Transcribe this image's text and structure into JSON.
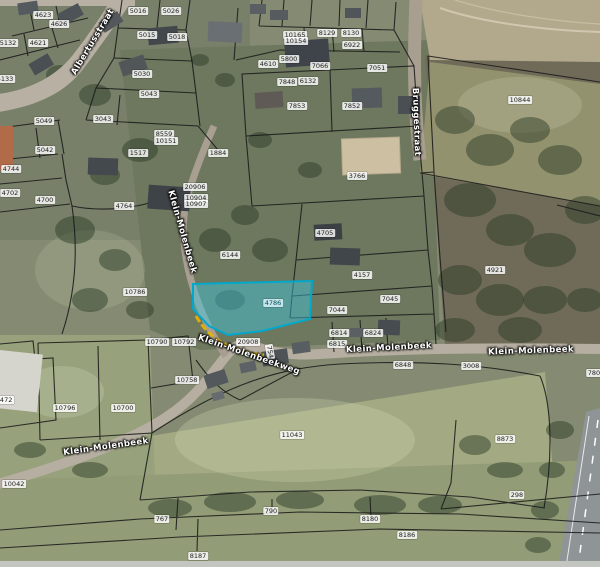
{
  "map": {
    "type": "cadastral-parcels-over-aerial-photo",
    "colors": {
      "highlight_fill": "#3fc8e2",
      "highlight_stroke": "#00a8cc",
      "selection_outline": "#e9b400",
      "parcel_boundary": "#1a1a1a",
      "label_background": "#ffffff",
      "label_text": "#1c1c1c"
    },
    "highlighted_parcel": {
      "id": "4786",
      "x": 273,
      "y": 303
    },
    "parcel_labels": [
      {
        "id": "4623",
        "x": 43,
        "y": 15
      },
      {
        "id": "4626",
        "x": 59,
        "y": 24
      },
      {
        "id": "4621",
        "x": 38,
        "y": 43
      },
      {
        "id": "5132",
        "x": 8,
        "y": 43
      },
      {
        "id": "5133",
        "x": 5,
        "y": 79
      },
      {
        "id": "5016",
        "x": 138,
        "y": 11
      },
      {
        "id": "5026",
        "x": 171,
        "y": 11
      },
      {
        "id": "5015",
        "x": 147,
        "y": 35
      },
      {
        "id": "5018",
        "x": 177,
        "y": 37
      },
      {
        "id": "5030",
        "x": 142,
        "y": 74
      },
      {
        "id": "5043",
        "x": 149,
        "y": 94
      },
      {
        "id": "3043",
        "x": 103,
        "y": 119
      },
      {
        "id": "5049",
        "x": 44,
        "y": 121
      },
      {
        "id": "8559",
        "x": 164,
        "y": 134
      },
      {
        "id": "10151",
        "x": 166,
        "y": 141
      },
      {
        "id": "1517",
        "x": 138,
        "y": 153
      },
      {
        "id": "5042",
        "x": 45,
        "y": 150
      },
      {
        "id": "4744",
        "x": 11,
        "y": 169
      },
      {
        "id": "4702",
        "x": 10,
        "y": 193
      },
      {
        "id": "4700",
        "x": 45,
        "y": 200
      },
      {
        "id": "10165",
        "x": 295,
        "y": 35
      },
      {
        "id": "10154",
        "x": 296,
        "y": 41
      },
      {
        "id": "8129",
        "x": 327,
        "y": 33
      },
      {
        "id": "8130",
        "x": 351,
        "y": 33
      },
      {
        "id": "6922",
        "x": 352,
        "y": 45
      },
      {
        "id": "5800",
        "x": 289,
        "y": 59
      },
      {
        "id": "4610",
        "x": 268,
        "y": 64
      },
      {
        "id": "7066",
        "x": 320,
        "y": 66
      },
      {
        "id": "7051",
        "x": 377,
        "y": 68
      },
      {
        "id": "7848",
        "x": 287,
        "y": 82
      },
      {
        "id": "6132",
        "x": 308,
        "y": 81
      },
      {
        "id": "7853",
        "x": 297,
        "y": 106
      },
      {
        "id": "7852",
        "x": 352,
        "y": 106
      },
      {
        "id": "1884",
        "x": 218,
        "y": 153
      },
      {
        "id": "20906",
        "x": 195,
        "y": 187
      },
      {
        "id": "10904",
        "x": 196,
        "y": 198
      },
      {
        "id": "10907",
        "x": 196,
        "y": 204
      },
      {
        "id": "4764",
        "x": 124,
        "y": 206
      },
      {
        "id": "3766",
        "x": 357,
        "y": 176
      },
      {
        "id": "4705",
        "x": 325,
        "y": 233
      },
      {
        "id": "6144",
        "x": 230,
        "y": 255
      },
      {
        "id": "4157",
        "x": 362,
        "y": 275
      },
      {
        "id": "10786",
        "x": 135,
        "y": 292
      },
      {
        "id": "7045",
        "x": 390,
        "y": 299
      },
      {
        "id": "7044",
        "x": 337,
        "y": 310
      },
      {
        "id": "6814",
        "x": 339,
        "y": 333
      },
      {
        "id": "6824",
        "x": 373,
        "y": 333
      },
      {
        "id": "6815",
        "x": 337,
        "y": 344
      },
      {
        "id": "6848",
        "x": 403,
        "y": 365
      },
      {
        "id": "3008",
        "x": 471,
        "y": 366
      },
      {
        "id": "10844",
        "x": 520,
        "y": 100
      },
      {
        "id": "4921",
        "x": 495,
        "y": 270
      },
      {
        "id": "20908",
        "x": 248,
        "y": 342
      },
      {
        "id": "754",
        "x": 270,
        "y": 352,
        "rotation": 80
      },
      {
        "id": "10790",
        "x": 157,
        "y": 342
      },
      {
        "id": "10792",
        "x": 184,
        "y": 342
      },
      {
        "id": "10758",
        "x": 187,
        "y": 380
      },
      {
        "id": "10796",
        "x": 65,
        "y": 408
      },
      {
        "id": "10700",
        "x": 123,
        "y": 408
      },
      {
        "id": "10472",
        "x": 2,
        "y": 400
      },
      {
        "id": "10042",
        "x": 14,
        "y": 484
      },
      {
        "id": "11043",
        "x": 292,
        "y": 435
      },
      {
        "id": "767",
        "x": 162,
        "y": 519
      },
      {
        "id": "790",
        "x": 271,
        "y": 511
      },
      {
        "id": "8180",
        "x": 370,
        "y": 519
      },
      {
        "id": "8186",
        "x": 407,
        "y": 535
      },
      {
        "id": "8187",
        "x": 198,
        "y": 556
      },
      {
        "id": "8873",
        "x": 505,
        "y": 439
      },
      {
        "id": "298",
        "x": 517,
        "y": 495
      },
      {
        "id": "7805",
        "x": 596,
        "y": 373
      }
    ],
    "street_labels": [
      {
        "text": "Albertusstraat",
        "x": 93,
        "y": 42,
        "rotation": -59
      },
      {
        "text": "Bruggestraat",
        "x": 416,
        "y": 122,
        "rotation": 88
      },
      {
        "text": "Klein-Molenbeek",
        "x": 182,
        "y": 232,
        "rotation": 74
      },
      {
        "text": "Klein-Molenbeekweg",
        "x": 249,
        "y": 355,
        "rotation": 19
      },
      {
        "text": "Klein-Molenbeek",
        "x": 389,
        "y": 348,
        "rotation": -3
      },
      {
        "text": "Klein-Molenbeek",
        "x": 531,
        "y": 351,
        "rotation": -2
      },
      {
        "text": "Klein-Molenbeek",
        "x": 106,
        "y": 447,
        "rotation": -8
      }
    ]
  }
}
